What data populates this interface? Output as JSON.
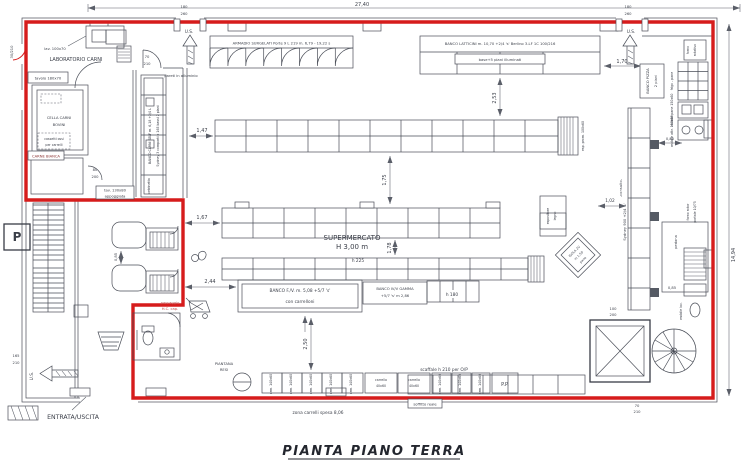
{
  "sheet": {
    "title": "PIANTA PIANO TERRA"
  },
  "colors": {
    "red_outline": "#d61c1c",
    "line": "#4a4e58",
    "text": "#3b3f49",
    "accent_text": "#bf5050"
  },
  "dimensions": {
    "top": "27,40",
    "right": "14,94",
    "d253": "2,53",
    "d170": "1,70",
    "d147": "1,47",
    "d167": "1,67",
    "d175": "1,75",
    "d178": "1,78",
    "d244": "2,44",
    "d085": "0,85",
    "d250": "2,50",
    "d102": "1,02"
  },
  "doors": {
    "us": "U.S.",
    "s180": "180",
    "s260": "260",
    "d30": "30/210",
    "d70a": "70",
    "d70b": "210",
    "d80a": "80",
    "d80b": "200",
    "d100a": "100",
    "d100b": "200",
    "d165a": "165",
    "d165b": "210",
    "entrance": "ENTRATA/USCITA"
  },
  "rooms": {
    "lab": "LABORATORIO CARNI",
    "cella_a": "CELLA CARNI",
    "cella_b": "BOVINI",
    "carne_bianca": "CARNE BIANCA",
    "super_a": "SUPERMERCATO",
    "super_b": "H 3,00 m",
    "parking": "P"
  },
  "fixtures": {
    "armadio": "ARMADIO SURGELATI  Porte 9 L 219  m. 6,79 - 19,22 s",
    "latticini_a": "BANCO LATTICINI  m. 10,70 +2/4 's'  Berlino 3-LF 1C 100/216",
    "latticini_b": "base+5 piani illuminati",
    "carni_self_a": "BANCO CARNI SELF  m. 6,18 +2/4 L",
    "carni_self_b": "Sydney 3 comparti x 165 bassi 2 piani",
    "fv_a": "BANCO F./V.  m. 5,08 +5/7 's'",
    "fv_b": "con carrelloni",
    "gamma_a": "BANCO IV/V GAMMA",
    "gamma_b": "+5/7 's'  m 2,86",
    "isola_a": "ISOLA 2V",
    "isola_b": "m 1,50",
    "isola_c": "pane",
    "pizza_a": "BANCO PIZZA",
    "pizza_b": "2 piani",
    "frigo_pane": "frigo - pane",
    "mobile_pane": "mobile pane 150x60",
    "mobile_attr": "mobile attr. 150x60",
    "forno_a": "forno rotor",
    "forno_b": "portale 10/75",
    "forno_sup_a": "forno",
    "forno_sup_b": "rotativo",
    "sydney900": "Sydney 900 +2/4 's'",
    "mobile_lav": "mobile lav."
  },
  "notes": {
    "pareti": "pareti in alluminio",
    "cassetti_a": "cassetti ossi",
    "cassetti_b": "per carrelli",
    "lav": "lav. 100x70",
    "tavolo": "tavolo 180x70",
    "tav130_a": "tav. 130x80",
    "tav130_b": "appoggiata",
    "passaggio_a": "passaggio",
    "passaggio_b": "H.C. cap.",
    "piantana_a": "PIANTANA",
    "piantana_b": "RESI",
    "zona": "zona carrelli spesa 8,06",
    "scaffale": "scaffale  h 210  per O/P",
    "soffione": "soffitto reale",
    "pedana": "pedana",
    "vetrinetta": "vetrinetta",
    "esp_prom": "esp. prom. 100x60",
    "esp_legno_a": "espositore",
    "esp_legno_b": "legno",
    "h225": "h 225",
    "h180": "h 180",
    "pp": "P.P.",
    "cell": "arm. 140x60",
    "carrello_a": "carrello",
    "carrello_b": "40x60",
    "consulto": "-consulto-"
  }
}
